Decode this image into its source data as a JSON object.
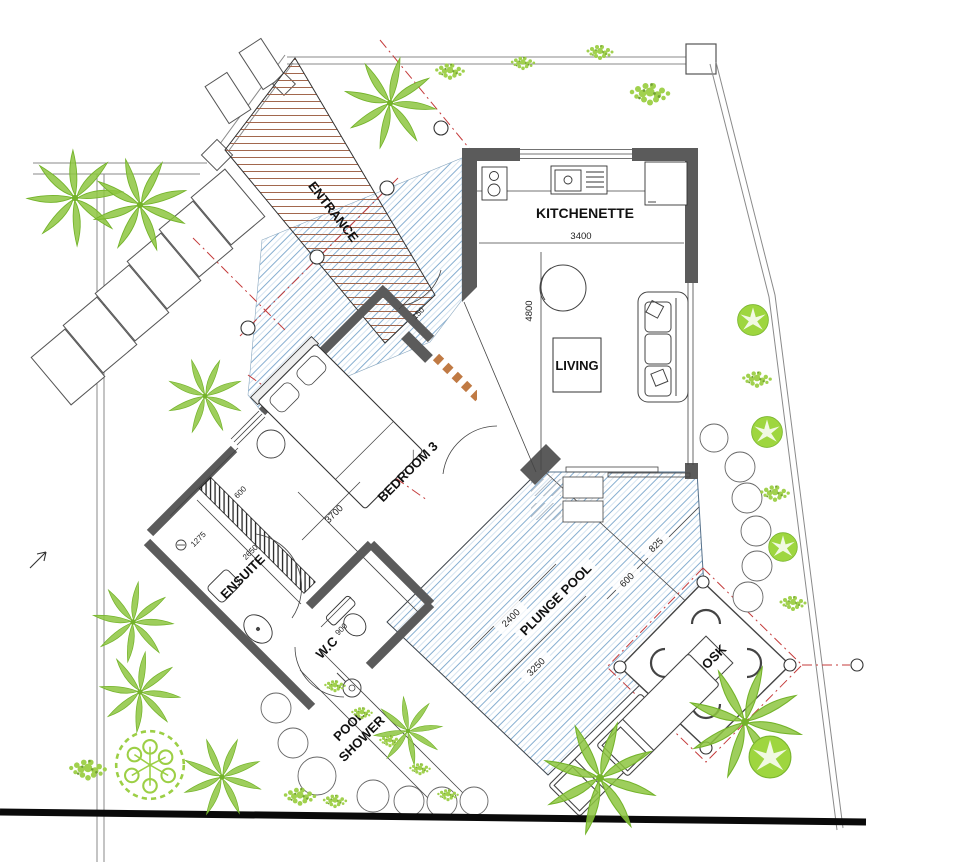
{
  "plan": {
    "rooms": {
      "entrance": "ENTRANCE",
      "kitchenette": "KITCHENETTE",
      "living": "LIVING",
      "bedroom": "BEDROOM 3",
      "ensuite": "ENSUITE",
      "wc": "W.C",
      "pool_shower_line1": "POOL",
      "pool_shower_line2": "SHOWER",
      "plunge_pool": "PLUNGE POOL",
      "kiosk": "KIOSK"
    },
    "dimensions": {
      "kitchenette_width": "3400",
      "living_length": "4800",
      "entry_offset": "150",
      "wardrobe_width": "600",
      "bedroom_length": "3700",
      "shower_width": "1275",
      "ensuite_length": "2650",
      "wc_width": "900",
      "pool_width": "2400",
      "pool_length": "3250",
      "pool_step_width": "600",
      "pool_corner": "825"
    },
    "colors": {
      "wall": "#5b5b5b",
      "water_line": "#86aed0",
      "deck_plank": "#a2674d",
      "roof_dash": "#c43b3b",
      "stepping_path": "#c07a44",
      "plant_green": "#8dc63f",
      "boundary": "#8a8a8a",
      "label_text": "#111111"
    }
  }
}
